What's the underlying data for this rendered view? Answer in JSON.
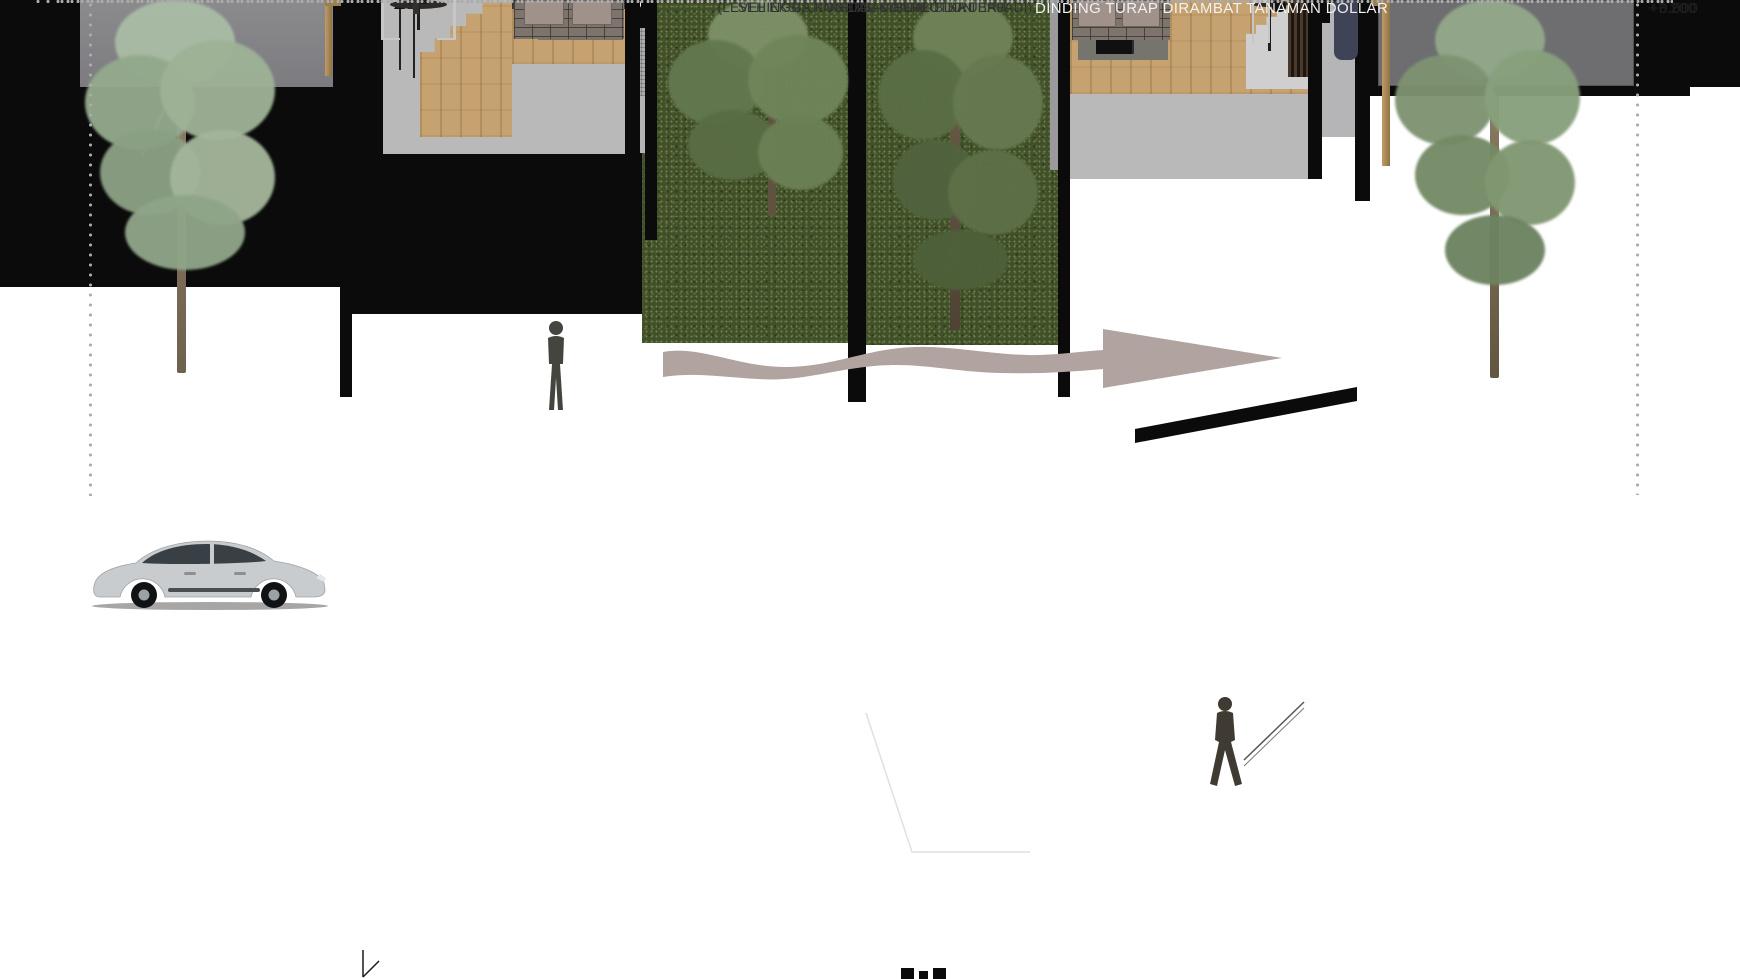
{
  "annotations": {
    "visual_connection": "VISUAL CONNECTION",
    "level_note_line1": "(LEVEL EKSISTING TIDAK PERLU DIRUBAH",
    "level_note_line2": "SEHINGGA KONEKSI VISUAL BISA TERJADI)",
    "wall_note": "DINDING TURAP DIRAMBAT TANAMAN DOLLAR"
  },
  "elevations": {
    "upper": "+7.200",
    "middle": "+3.500",
    "ground": "+0.000"
  },
  "colors": {
    "background": "#ffffff",
    "ground_section": "#0b0b0b",
    "green_wall": "#41502b",
    "flow_arrow": "#b1a4a0",
    "retaining_wall": "#6e6e71",
    "wood": "#c5a26f",
    "guide_dots": "#ababab"
  }
}
